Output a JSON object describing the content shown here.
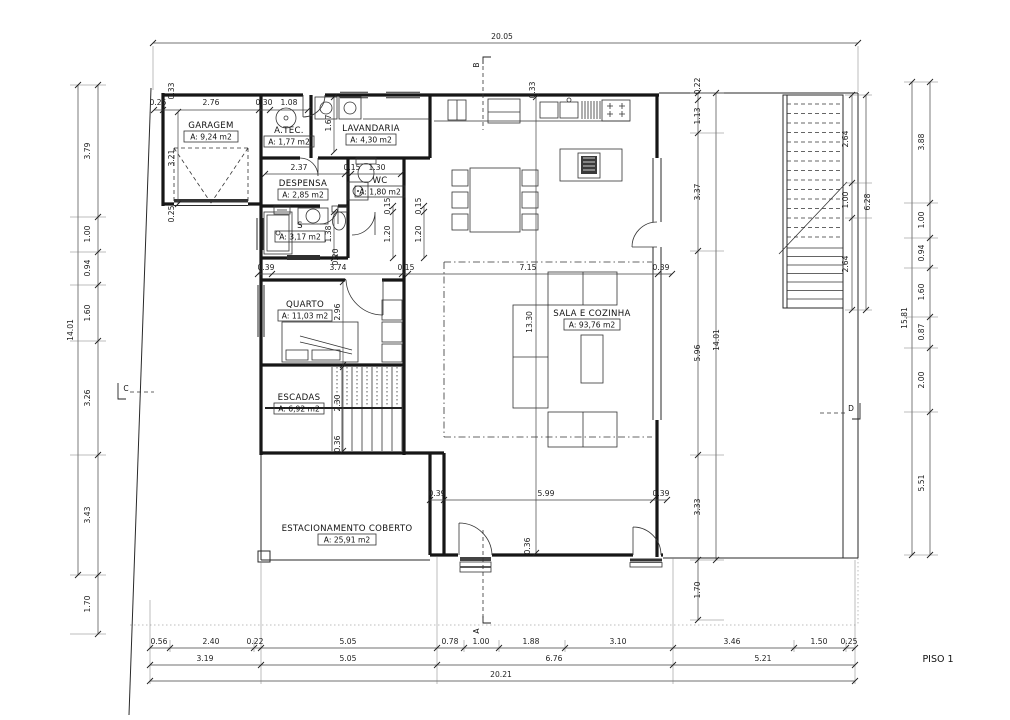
{
  "drawing": {
    "floor_label": "PISO 1"
  },
  "rooms": {
    "garagem": {
      "name": "GARAGEM",
      "area": "A: 9,24 m2"
    },
    "atec": {
      "name": "A.TEC.",
      "area": "A: 1,77 m2"
    },
    "lavandaria": {
      "name": "LAVANDARIA",
      "area": "A: 4,30 m2"
    },
    "despensa": {
      "name": "DESPENSA",
      "area": "A: 2,85 m2"
    },
    "wc": {
      "name": "WC",
      "area": "A: 1,80 m2"
    },
    "instalacao": {
      "name": "S",
      "area": "A: 3,17 m2"
    },
    "quarto": {
      "name": "QUARTO",
      "area": "A: 11,03 m2"
    },
    "escadas": {
      "name": "ESCADAS",
      "area": "A: 6,92 m2"
    },
    "sala": {
      "name": "SALA E COZINHA",
      "area": "A: 93,76 m2"
    },
    "estacionamento": {
      "name": "ESTACIONAMENTO COBERTO",
      "area": "A: 25,91 m2"
    }
  },
  "markers": {
    "a": "A",
    "b": "B",
    "c": "C",
    "d": "D"
  },
  "dims": {
    "top_total": "20.05",
    "bottom_row1": [
      "0.56",
      "2.40",
      "0.22",
      "5.05",
      "0.78",
      "1.00",
      "1.88",
      "3.10",
      "3.46",
      "1.50",
      "0.25"
    ],
    "bottom_row2": [
      "3.19",
      "5.05",
      "6.76",
      "5.21"
    ],
    "bottom_total": "20.21",
    "left_col": [
      "3.79",
      "1.00",
      "0.94",
      "1.60",
      "3.26",
      "3.43",
      "1.70"
    ],
    "left_total": "14.01",
    "right_inner_col": [
      "0.22",
      "1.13",
      "3.37",
      "5.96",
      "3.33",
      "1.70"
    ],
    "right_inner_total": "14.01",
    "right_outer_col": [
      "3.88",
      "1.00",
      "0.94",
      "1.60",
      "0.87",
      "2.00",
      "5.51"
    ],
    "right_outer_total": "15.81",
    "stairs_col": [
      "2.64",
      "1.00",
      "2.64"
    ],
    "stairs_total": "6.28",
    "garage_row": [
      "0.25",
      "2.76",
      "0.30",
      "1.08"
    ],
    "corridor_row": [
      "0.39",
      "3.74",
      "0.15",
      "7.15",
      "0.39"
    ],
    "parking_row": [
      "0.39",
      "5.99",
      "0.39"
    ],
    "misc": {
      "garage_wall_top": "0.33",
      "garage_depth": "3.21",
      "garage_wall_bottom": "0.25",
      "hall_depth": "1.67",
      "despensa_width": "2.37",
      "wc_wall": "0.15",
      "wc_width": "1.30",
      "wc_depth_wall": "0.15",
      "wc_depth": "1.20",
      "bath_depth": "1.38",
      "hall_gap": "0.20",
      "quarto_depth": "2.96",
      "sala_depth": "13.30",
      "escadas_depth": "2.30",
      "escadas_wall": "0.36",
      "kitchen_wall": "0.33",
      "entry_wall": "0.36"
    }
  }
}
